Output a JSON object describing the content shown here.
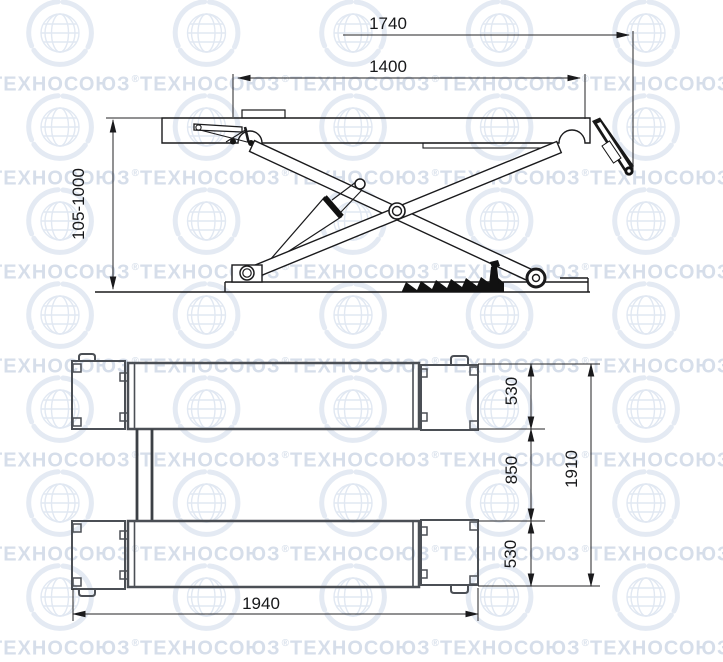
{
  "watermark": {
    "text": "ТЕХНОСОЮЗ",
    "reg": "®"
  },
  "side_view": {
    "title": "scissor-lift-side-elevation",
    "dims": {
      "overall_length": "1740",
      "platform_length": "1400",
      "lift_height_range": "105-1000"
    }
  },
  "plan_view": {
    "title": "scissor-lift-plan",
    "dims": {
      "platform_width_top": "530",
      "track_gap": "850",
      "platform_width_bottom": "530",
      "overall_width": "1910",
      "overall_length": "1940"
    }
  },
  "colors": {
    "line_dark": "#1a1a1c",
    "line_gray": "#4b4f55",
    "watermark_text": "#d6deea",
    "watermark_logo": "#e2e8f2"
  }
}
